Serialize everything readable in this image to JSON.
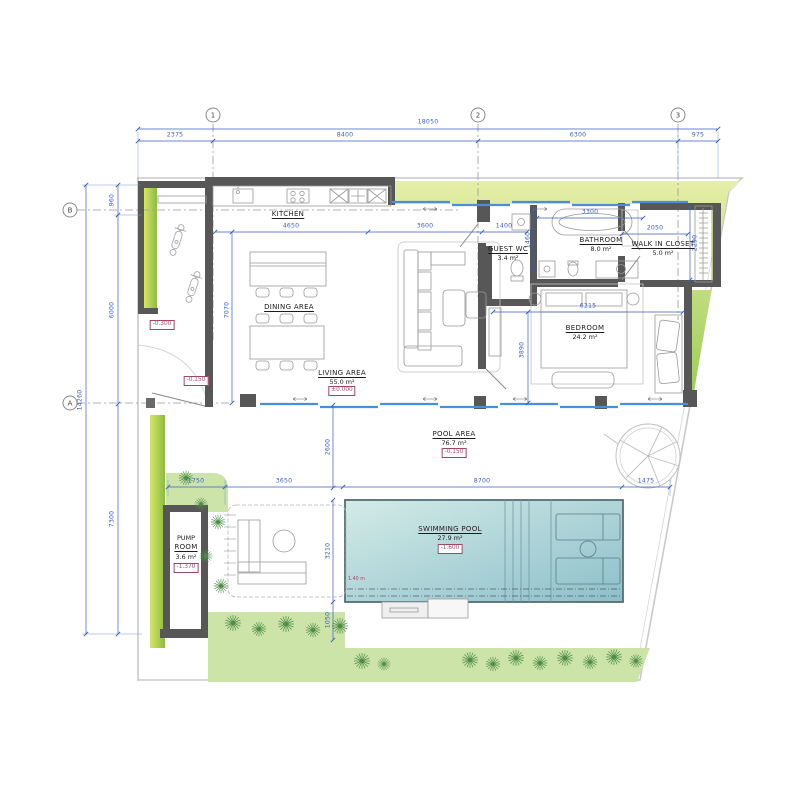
{
  "plan": {
    "grid": {
      "c1": "1",
      "c2": "2",
      "c3": "3",
      "rB": "B",
      "rA": "A"
    },
    "dims": {
      "total_w": "18050",
      "seg1": "2375",
      "seg2": "8400",
      "seg3": "6300",
      "seg4": "975",
      "total_h": "14260",
      "h1": "960",
      "h2": "6000",
      "h3": "7300",
      "kitchen_w": "4650",
      "living_w": "3600",
      "hall_w": "1400",
      "bath_w": "3300",
      "closet_w": "2050",
      "closet_h": "2290",
      "wc_h": "1460",
      "interior_h": "7070",
      "bedroom_w": "6215",
      "bedroom_h": "3890",
      "pool_off": "2600",
      "pool_h": "3210",
      "pool_s": "1050",
      "deck1": "1750",
      "deck2": "3650",
      "pool_w": "8700",
      "pool_e": "1475"
    },
    "rooms": {
      "kitchen": {
        "name": "KITCHEN"
      },
      "dining": {
        "name": "DINING AREA"
      },
      "living": {
        "name": "LIVING AREA",
        "area": "55.0 m²",
        "level": "±0.000"
      },
      "guest_wc": {
        "name": "GUEST WC",
        "area": "3.4 m²"
      },
      "bathroom": {
        "name": "BATHROOM",
        "area": "8.0 m²"
      },
      "closet": {
        "name": "WALK IN CLOSET",
        "area": "5.0 m²"
      },
      "bedroom": {
        "name": "BEDROOM",
        "area": "24.2 m²"
      },
      "pool_area": {
        "name": "POOL AREA",
        "area": "76.7 m²",
        "level": "-0.150"
      },
      "pool": {
        "name": "SWIMMING POOL",
        "area": "27.9 m²",
        "level": "-1.600",
        "depth": "1.40 m"
      },
      "pump": {
        "name1": "PUMP",
        "name2": "ROOM",
        "area": "3.6 m²",
        "level": "-1.370"
      }
    },
    "levels": {
      "carport": "-0.300",
      "entry": "-0.150"
    },
    "colors": {
      "dimension": "#3a5fc0",
      "wall": "#575757",
      "level_marker": "#a04767",
      "glass": "#4a90d9",
      "pool_light": "#cde8e4",
      "pool_dark": "#8dbfca",
      "green_light": "#dde98a",
      "green_dark": "#9ccb57",
      "lawn": "#cde4a9"
    }
  }
}
